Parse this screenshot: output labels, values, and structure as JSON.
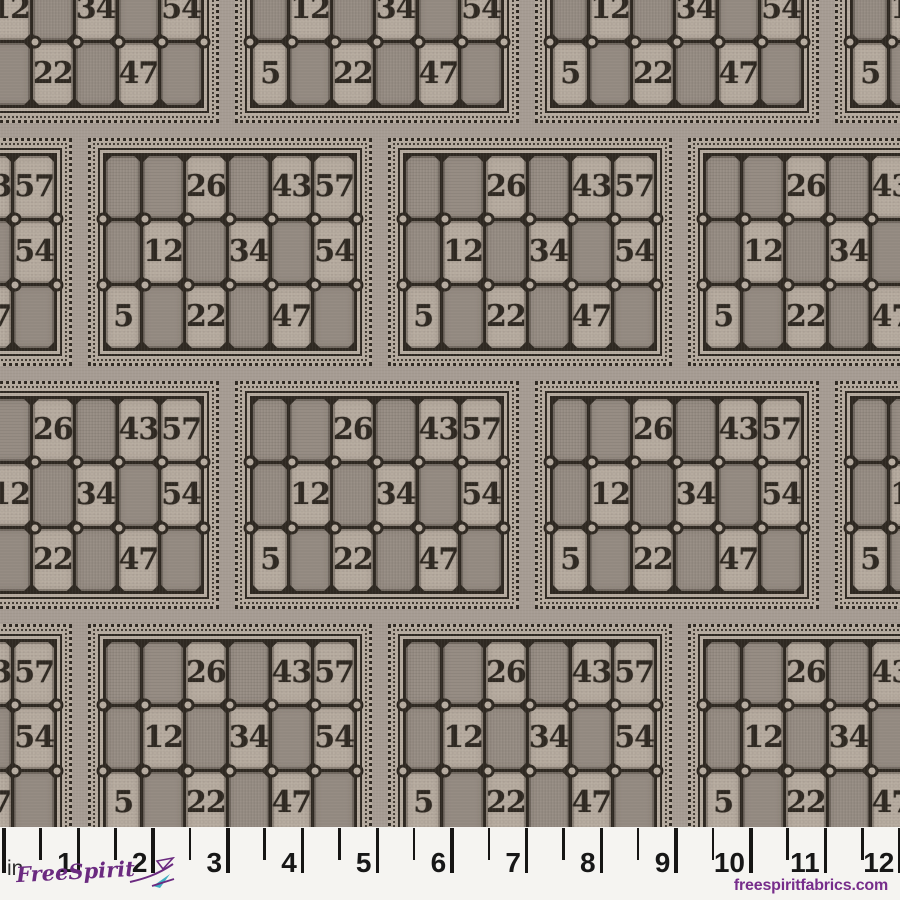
{
  "fabric": {
    "card_numbers_grid": [
      [
        null,
        null,
        "26",
        null,
        "43",
        "57"
      ],
      [
        null,
        "12",
        null,
        "34",
        null,
        "54"
      ],
      [
        "5",
        null,
        "22",
        null,
        "47",
        null
      ]
    ],
    "colors": {
      "background": "#a69c93",
      "card_light": "#b6ab9f",
      "cell_dark": "#978d84",
      "ink": "#2f2922"
    }
  },
  "ruler": {
    "unit_label": "in",
    "inch_labels": [
      "1",
      "2",
      "3",
      "4",
      "5",
      "6",
      "7",
      "8",
      "9",
      "10",
      "11",
      "12"
    ]
  },
  "footer": {
    "logo_text": "FreeSpirit",
    "website": "freespiritfabrics.com",
    "brand_purple": "#6b2a80",
    "brand_teal": "#3fafc2",
    "website_color": "#772d8b"
  }
}
